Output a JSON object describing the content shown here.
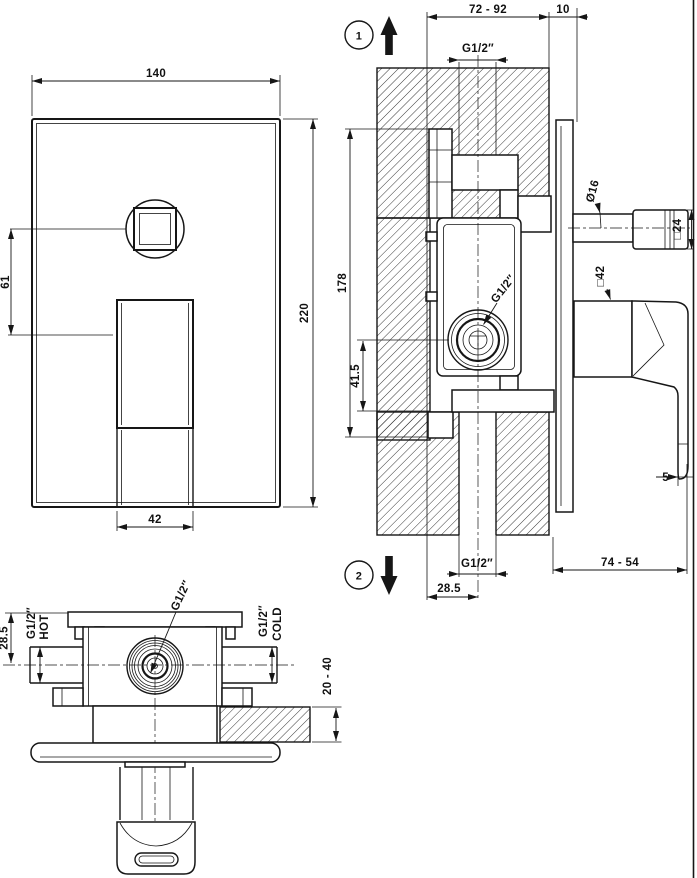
{
  "front_view": {
    "width": "140",
    "height": "220",
    "button_offset": "61",
    "handle_width": "42"
  },
  "side_view": {
    "depth_range": "72 - 92",
    "plate_depth": "10",
    "step_marker_1": "1",
    "top_port_thread": "G1/2″",
    "body_height": "178",
    "outlet_offset": "41.5",
    "stem_diameter": "Ø16",
    "knob_square": "□24",
    "handle_square": "□42",
    "valve_port_thread": "G1/2″",
    "lever_gap": "5",
    "handle_depth_range": "74 - 54",
    "bottom_port_thread": "G1/2″",
    "bottom_port_offset": "28.5",
    "step_marker_2": "2"
  },
  "top_view": {
    "axis_offset": "28.5",
    "hot_thread": "G1/2″",
    "hot_label": "HOT",
    "center_thread": "G1/2″",
    "cold_thread": "G1/2″",
    "cold_label": "COLD",
    "wall_depth_range": "20 - 40"
  }
}
